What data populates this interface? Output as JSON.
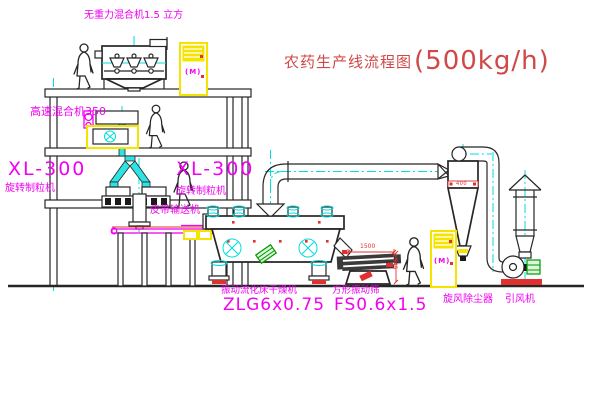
{
  "title": {
    "cn": "农药生产线流程图",
    "capacity": "(500kg/h)"
  },
  "labels": {
    "gravity_mixer": "无重力混合机1.5 立方",
    "high_speed_mixer": "高速混合机350",
    "granulator_left": {
      "model": "XL-300",
      "name": "旋转制粒机"
    },
    "granulator_right": {
      "model": "XL-300",
      "name": "旋转制粒机"
    },
    "belt_conveyor": "皮带输送机",
    "dryer": {
      "name": "振动流化床干燥机",
      "model": "ZLG6x0.75"
    },
    "sieve": {
      "name": "方形振动筛",
      "model": "FS0.6x1.5"
    },
    "cyclone": "旋风除尘器",
    "fan": "引风机"
  },
  "dimensions": {
    "sieve_length": "1500",
    "sieve_height": "545",
    "cyclone_dia": "400"
  },
  "cabinets": {
    "mark": "(M)"
  },
  "colors": {
    "line": "#262626",
    "cyan": "#00dede",
    "magenta": "#f200f2",
    "red": "#e03030",
    "yellow": "#f5e400",
    "green": "#009900",
    "title_red": "#d04848"
  }
}
